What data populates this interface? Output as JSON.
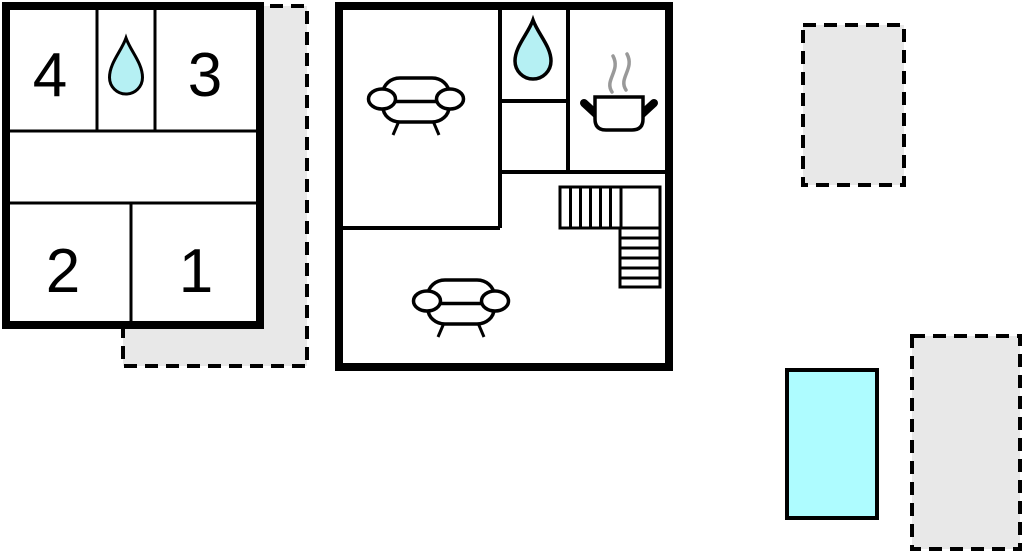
{
  "diagram": {
    "type": "floor-plan",
    "title": "holiday-home floor plan"
  },
  "colors": {
    "wall": "#000000",
    "terrace_fill": "#e8e8e8",
    "water_drop": "#b5f0f3",
    "pool_fill": "#aefcff",
    "steam": "#999999",
    "room_fill": "#ffffff"
  },
  "upper_floor": {
    "rooms": [
      {
        "label": "4"
      },
      {
        "label": "3"
      },
      {
        "label": "2"
      },
      {
        "label": "1"
      }
    ],
    "bathroom_icon": "water-drop"
  },
  "ground_floor": {
    "icons": [
      "sofa",
      "water-drop",
      "cooking-pot",
      "stairs",
      "sofa"
    ]
  },
  "outdoor": {
    "terraces": [
      {
        "position": "wrap-around-upper-floor"
      },
      {
        "position": "top-right"
      },
      {
        "position": "bottom-right"
      }
    ],
    "pool": {
      "shape": "rectangle"
    }
  }
}
